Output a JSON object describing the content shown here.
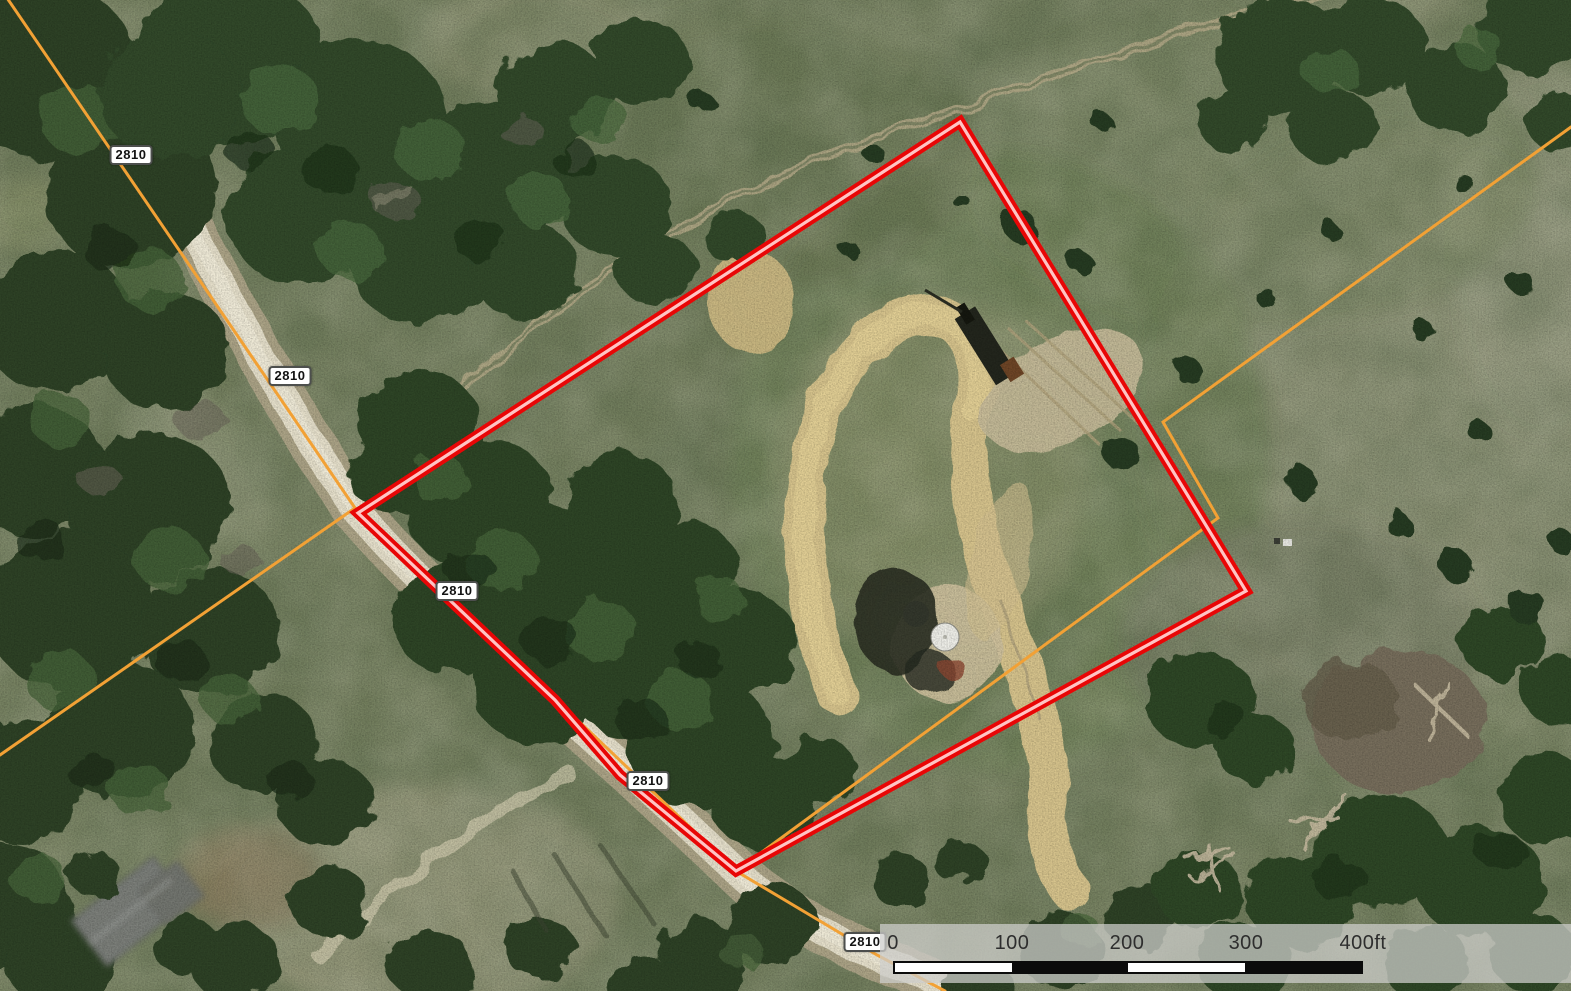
{
  "map": {
    "road_labels": [
      {
        "text": "2810"
      },
      {
        "text": "2810"
      },
      {
        "text": "2810"
      },
      {
        "text": "2810"
      },
      {
        "text": "2810"
      }
    ],
    "boundary_color": "#e80606",
    "boundary_inner_color": "#ffc4c4",
    "parcel_line_color": "#f2a135",
    "scale_bar": {
      "ticks": [
        "0",
        "100",
        "200",
        "300",
        "400ft"
      ]
    }
  }
}
